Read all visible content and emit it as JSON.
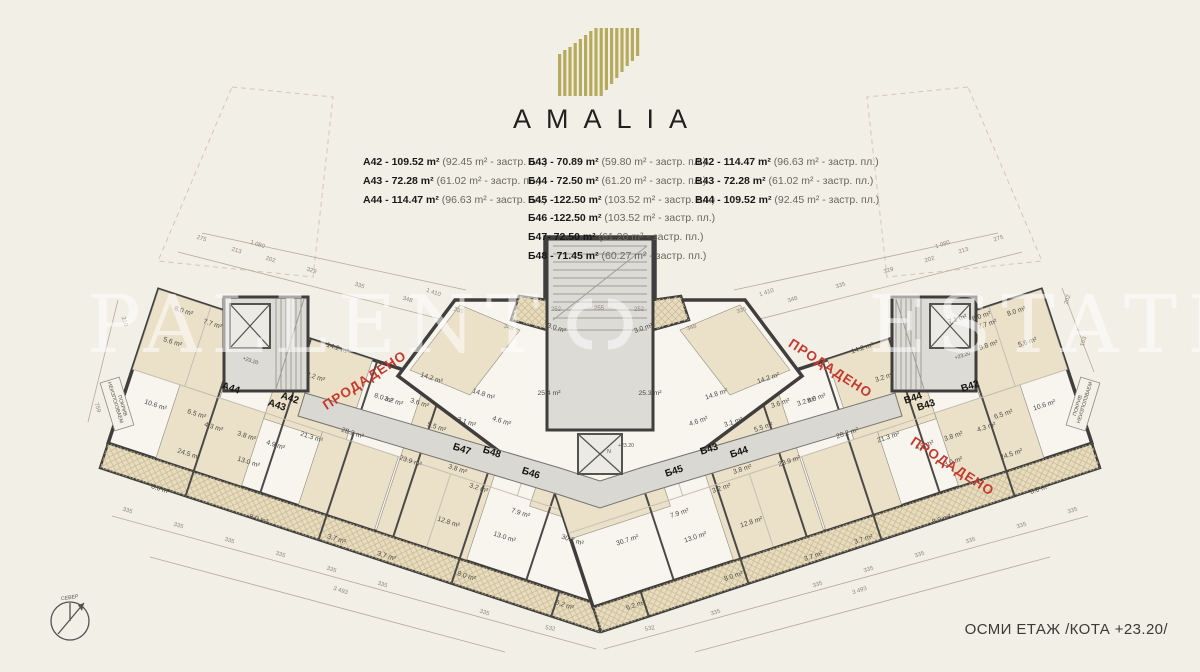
{
  "logo": {
    "title": "AMALIA"
  },
  "colors": {
    "accent_gold": "#b6aa5c",
    "sold_red": "#c43a2f",
    "wall": "#3f3e3c",
    "room_beige": "#ebe0c8"
  },
  "legend": {
    "columns": [
      {
        "items": [
          {
            "label": "A42 - 109.52 m²",
            "note": "(92.45 m² - застр. пл.)"
          },
          {
            "label": "A43 - 72.28 m²",
            "note": "(61.02 m² - застр. пл.)"
          },
          {
            "label": "A44 - 114.47 m²",
            "note": "(96.63 m² - застр. пл.)"
          }
        ]
      },
      {
        "items": [
          {
            "label": "Б43 -  70.89 m²",
            "note": "(59.80 m² - застр. пл.)"
          },
          {
            "label": "Б44 -  72.50 m²",
            "note": "(61.20 m² - застр. пл.)"
          },
          {
            "label": "Б45 -122.50 m²",
            "note": "(103.52 m² - застр. пл.)"
          },
          {
            "label": "Б46 -122.50 m²",
            "note": "(103.52 m² - застр. пл.)"
          },
          {
            "label": "Б47-  72.50 m²",
            "note": "(61.20 m² - застр. пл.)"
          },
          {
            "label": "Б48 -  71.45 m²",
            "note": "(60.27 m² - застр. пл.)"
          }
        ]
      },
      {
        "items": [
          {
            "label": "В42 -  114.47 m²",
            "note": "(96.63 m² - застр. пл.)"
          },
          {
            "label": "В43 -  72.28 m²",
            "note": "(61.02 m² - застр. пл.)"
          },
          {
            "label": "В44 - 109.52 m²",
            "note": "(92.45 m² - застр. пл.)"
          }
        ]
      }
    ]
  },
  "plan": {
    "floor_title": "ОСМИ ЕТАЖ /КОТА +23.20/",
    "watermark": {
      "left": "PALLENT",
      "right": "ESTATE"
    },
    "unit_labels": [
      {
        "t": "A44",
        "x": 230,
        "y": 391,
        "r": 18
      },
      {
        "t": "A43",
        "x": 276,
        "y": 408,
        "r": 18
      },
      {
        "t": "A42",
        "x": 289,
        "y": 401,
        "r": 18
      },
      {
        "t": "Б47",
        "x": 461,
        "y": 452,
        "r": 18
      },
      {
        "t": "Б48",
        "x": 491,
        "y": 455,
        "r": 18
      },
      {
        "t": "Б46",
        "x": 530,
        "y": 476,
        "r": 18
      },
      {
        "t": "Б45",
        "x": 675,
        "y": 474,
        "r": -18
      },
      {
        "t": "Б43",
        "x": 710,
        "y": 452,
        "r": -18
      },
      {
        "t": "Б44",
        "x": 740,
        "y": 455,
        "r": -18
      },
      {
        "t": "В44",
        "x": 914,
        "y": 401,
        "r": -18
      },
      {
        "t": "В43",
        "x": 927,
        "y": 408,
        "r": -18
      },
      {
        "t": "В42",
        "x": 971,
        "y": 389,
        "r": -18
      }
    ],
    "sold_stamps": [
      {
        "t": "ПРОДАДЕНО",
        "x": 367,
        "y": 384,
        "r": -33
      },
      {
        "t": "ПРОДАДЕНО",
        "x": 828,
        "y": 372,
        "r": 33
      },
      {
        "t": "ПРОДАДЕНО",
        "x": 950,
        "y": 470,
        "r": 33
      }
    ],
    "area_labels": [
      {
        "t": "8.0 m²",
        "x": 183,
        "y": 313,
        "r": 18
      },
      {
        "t": "7.7 m²",
        "x": 212,
        "y": 326,
        "r": 18
      },
      {
        "t": "5.6 m²",
        "x": 172,
        "y": 344,
        "r": 18
      },
      {
        "t": "14.2 m²",
        "x": 337,
        "y": 350,
        "r": 18
      },
      {
        "t": "3.2 m²",
        "x": 315,
        "y": 379,
        "r": 18
      },
      {
        "t": "3.2 m²",
        "x": 393,
        "y": 403,
        "r": 18
      },
      {
        "t": "10.6 m²",
        "x": 155,
        "y": 407,
        "r": 18
      },
      {
        "t": "6.5 m²",
        "x": 196,
        "y": 416,
        "r": 18
      },
      {
        "t": "4.3 m²",
        "x": 213,
        "y": 429,
        "r": 18
      },
      {
        "t": "3.8 m²",
        "x": 246,
        "y": 438,
        "r": 18
      },
      {
        "t": "4.9 m²",
        "x": 275,
        "y": 447,
        "r": 18
      },
      {
        "t": "21.3 m²",
        "x": 311,
        "y": 439,
        "r": 18
      },
      {
        "t": "8.0 m²",
        "x": 383,
        "y": 400,
        "r": 18
      },
      {
        "t": "28.2 m²",
        "x": 352,
        "y": 435,
        "r": 18
      },
      {
        "t": "24.5 m²",
        "x": 188,
        "y": 456,
        "r": 18
      },
      {
        "t": "13.0 m²",
        "x": 248,
        "y": 464,
        "r": 18
      },
      {
        "t": "23.9 m²",
        "x": 410,
        "y": 463,
        "r": 18
      },
      {
        "t": "8.0 m²",
        "x": 160,
        "y": 491,
        "r": 18
      },
      {
        "t": "8.0 m²",
        "x": 258,
        "y": 521,
        "r": 18
      },
      {
        "t": "3.7 m²",
        "x": 336,
        "y": 541,
        "r": 18
      },
      {
        "t": "3.7 m²",
        "x": 386,
        "y": 558,
        "r": 18
      },
      {
        "t": "12.8 m²",
        "x": 448,
        "y": 524,
        "r": 18
      },
      {
        "t": "13.0 m²",
        "x": 504,
        "y": 539,
        "r": 18
      },
      {
        "t": "7.9 m²",
        "x": 520,
        "y": 515,
        "r": 18
      },
      {
        "t": "3.2 m²",
        "x": 478,
        "y": 490,
        "r": 18
      },
      {
        "t": "3.8 m²",
        "x": 457,
        "y": 471,
        "r": 18
      },
      {
        "t": "5.5 m²",
        "x": 436,
        "y": 429,
        "r": 18
      },
      {
        "t": "3.1 m²",
        "x": 466,
        "y": 424,
        "r": 18
      },
      {
        "t": "4.6 m²",
        "x": 501,
        "y": 423,
        "r": 18
      },
      {
        "t": "14.2 m²",
        "x": 431,
        "y": 380,
        "r": 18
      },
      {
        "t": "14.8 m²",
        "x": 483,
        "y": 396,
        "r": 18
      },
      {
        "t": "3.6 m²",
        "x": 419,
        "y": 405,
        "r": 18
      },
      {
        "t": "8.0 m²",
        "x": 466,
        "y": 578,
        "r": 18
      },
      {
        "t": "6.2 m²",
        "x": 564,
        "y": 607,
        "r": 18
      },
      {
        "t": "30.7 m²",
        "x": 572,
        "y": 542,
        "r": 18
      },
      {
        "t": "3.0 m²",
        "x": 556,
        "y": 330,
        "r": 18
      },
      {
        "t": "25.4 m²",
        "x": 549,
        "y": 395,
        "r": 0
      },
      {
        "t": "25.3 m²",
        "x": 650,
        "y": 395,
        "r": 0
      },
      {
        "t": "3.0 m²",
        "x": 644,
        "y": 330,
        "r": -18
      },
      {
        "t": "30.7 m²",
        "x": 628,
        "y": 542,
        "r": -18
      },
      {
        "t": "6.2 m²",
        "x": 636,
        "y": 607,
        "r": -18
      },
      {
        "t": "8.0 m²",
        "x": 734,
        "y": 578,
        "r": -18
      },
      {
        "t": "3.6 m²",
        "x": 781,
        "y": 405,
        "r": -18
      },
      {
        "t": "14.8 m²",
        "x": 717,
        "y": 396,
        "r": -18
      },
      {
        "t": "14.2 m²",
        "x": 769,
        "y": 380,
        "r": -18
      },
      {
        "t": "4.6 m²",
        "x": 699,
        "y": 423,
        "r": -18
      },
      {
        "t": "3.1 m²",
        "x": 734,
        "y": 424,
        "r": -18
      },
      {
        "t": "5.5 m²",
        "x": 764,
        "y": 429,
        "r": -18
      },
      {
        "t": "3.8 m²",
        "x": 743,
        "y": 471,
        "r": -18
      },
      {
        "t": "3.2 m²",
        "x": 722,
        "y": 490,
        "r": -18
      },
      {
        "t": "7.9 m²",
        "x": 680,
        "y": 515,
        "r": -18
      },
      {
        "t": "13.0 m²",
        "x": 696,
        "y": 539,
        "r": -18
      },
      {
        "t": "12.8 m²",
        "x": 752,
        "y": 524,
        "r": -18
      },
      {
        "t": "3.7 m²",
        "x": 814,
        "y": 558,
        "r": -18
      },
      {
        "t": "3.7 m²",
        "x": 864,
        "y": 541,
        "r": -18
      },
      {
        "t": "8.0 m²",
        "x": 942,
        "y": 521,
        "r": -18
      },
      {
        "t": "8.0 m²",
        "x": 1040,
        "y": 491,
        "r": -18
      },
      {
        "t": "23.9 m²",
        "x": 790,
        "y": 463,
        "r": -18
      },
      {
        "t": "13.0 m²",
        "x": 952,
        "y": 464,
        "r": -18
      },
      {
        "t": "24.5 m²",
        "x": 1012,
        "y": 456,
        "r": -18
      },
      {
        "t": "21.3 m²",
        "x": 889,
        "y": 439,
        "r": -18
      },
      {
        "t": "28.2 m²",
        "x": 848,
        "y": 435,
        "r": -18
      },
      {
        "t": "4.9 m²",
        "x": 925,
        "y": 447,
        "r": -18
      },
      {
        "t": "3.8 m²",
        "x": 954,
        "y": 438,
        "r": -18
      },
      {
        "t": "4.3 m²",
        "x": 987,
        "y": 429,
        "r": -18
      },
      {
        "t": "6.5 m²",
        "x": 1004,
        "y": 416,
        "r": -18
      },
      {
        "t": "10.6 m²",
        "x": 1045,
        "y": 407,
        "r": -18
      },
      {
        "t": "8.0 m²",
        "x": 817,
        "y": 400,
        "r": -18
      },
      {
        "t": "3.2 m²",
        "x": 885,
        "y": 379,
        "r": -18
      },
      {
        "t": "3.2 m²",
        "x": 807,
        "y": 403,
        "r": -18
      },
      {
        "t": "14.2 m²",
        "x": 863,
        "y": 350,
        "r": -18
      },
      {
        "t": "5.6 m²",
        "x": 1028,
        "y": 344,
        "r": -18
      },
      {
        "t": "7.7 m²",
        "x": 988,
        "y": 326,
        "r": -18
      },
      {
        "t": "8.0 m²",
        "x": 1017,
        "y": 313,
        "r": -18
      },
      {
        "t": "7.1 m²",
        "x": 958,
        "y": 321,
        "r": -18
      },
      {
        "t": "6.0 m²",
        "x": 982,
        "y": 318,
        "r": -18
      },
      {
        "t": "9.8 m²",
        "x": 989,
        "y": 347,
        "r": -18
      }
    ],
    "dim_labels": [
      {
        "t": "275",
        "x": 201,
        "y": 240,
        "r": 18
      },
      {
        "t": "1 080",
        "x": 257,
        "y": 246,
        "r": 18
      },
      {
        "t": "213",
        "x": 236,
        "y": 252,
        "r": 18
      },
      {
        "t": "202",
        "x": 270,
        "y": 261,
        "r": 18
      },
      {
        "t": "329",
        "x": 311,
        "y": 272,
        "r": 18
      },
      {
        "t": "335",
        "x": 359,
        "y": 287,
        "r": 18
      },
      {
        "t": "1 410",
        "x": 433,
        "y": 294,
        "r": 18
      },
      {
        "t": "348",
        "x": 407,
        "y": 301,
        "r": 18
      },
      {
        "t": "335",
        "x": 458,
        "y": 312,
        "r": 18
      },
      {
        "t": "348",
        "x": 508,
        "y": 329,
        "r": 18
      },
      {
        "t": "252",
        "x": 556,
        "y": 311,
        "r": 0
      },
      {
        "t": "255",
        "x": 599,
        "y": 310,
        "r": 0
      },
      {
        "t": "252",
        "x": 639,
        "y": 311,
        "r": 0
      },
      {
        "t": "348",
        "x": 692,
        "y": 329,
        "r": -18
      },
      {
        "t": "335",
        "x": 742,
        "y": 312,
        "r": -18
      },
      {
        "t": "348",
        "x": 793,
        "y": 301,
        "r": -18
      },
      {
        "t": "1 410",
        "x": 767,
        "y": 294,
        "r": -18
      },
      {
        "t": "335",
        "x": 841,
        "y": 287,
        "r": -18
      },
      {
        "t": "329",
        "x": 889,
        "y": 272,
        "r": -18
      },
      {
        "t": "202",
        "x": 930,
        "y": 261,
        "r": -18
      },
      {
        "t": "213",
        "x": 964,
        "y": 252,
        "r": -18
      },
      {
        "t": "1 080",
        "x": 943,
        "y": 246,
        "r": -18
      },
      {
        "t": "275",
        "x": 999,
        "y": 240,
        "r": -18
      },
      {
        "t": "335",
        "x": 127,
        "y": 512,
        "r": 18
      },
      {
        "t": "335",
        "x": 178,
        "y": 527,
        "r": 18
      },
      {
        "t": "335",
        "x": 229,
        "y": 542,
        "r": 18
      },
      {
        "t": "335",
        "x": 280,
        "y": 556,
        "r": 18
      },
      {
        "t": "335",
        "x": 331,
        "y": 571,
        "r": 18
      },
      {
        "t": "3 493",
        "x": 340,
        "y": 592,
        "r": 18
      },
      {
        "t": "335",
        "x": 382,
        "y": 586,
        "r": 18
      },
      {
        "t": "335",
        "x": 484,
        "y": 614,
        "r": 18
      },
      {
        "t": "532",
        "x": 550,
        "y": 630,
        "r": 10
      },
      {
        "t": "532",
        "x": 650,
        "y": 630,
        "r": -10
      },
      {
        "t": "335",
        "x": 716,
        "y": 614,
        "r": -18
      },
      {
        "t": "335",
        "x": 818,
        "y": 586,
        "r": -18
      },
      {
        "t": "3 493",
        "x": 860,
        "y": 592,
        "r": -18
      },
      {
        "t": "335",
        "x": 869,
        "y": 571,
        "r": -18
      },
      {
        "t": "335",
        "x": 920,
        "y": 556,
        "r": -18
      },
      {
        "t": "335",
        "x": 971,
        "y": 542,
        "r": -18
      },
      {
        "t": "335",
        "x": 1022,
        "y": 527,
        "r": -18
      },
      {
        "t": "335",
        "x": 1073,
        "y": 512,
        "r": -18
      },
      {
        "t": "210",
        "x": 123,
        "y": 322,
        "r": 72
      },
      {
        "t": "759",
        "x": 96,
        "y": 408,
        "r": 72
      },
      {
        "t": "202",
        "x": 1069,
        "y": 300,
        "r": -72
      },
      {
        "t": "103",
        "x": 1085,
        "y": 342,
        "r": -72
      }
    ],
    "misc_labels": [
      {
        "t": "+23.20",
        "x": 250,
        "y": 362,
        "r": 18
      },
      {
        "t": "+23.20",
        "x": 626,
        "y": 447,
        "r": 0
      },
      {
        "t": "+23.20",
        "x": 963,
        "y": 357,
        "r": -18
      },
      {
        "t": "N",
        "x": 609,
        "y": 453,
        "r": 0
      },
      {
        "t": "СЕВЕР",
        "x": 70,
        "y": 599,
        "r": -8
      },
      {
        "t": "НЕИЗПОЛЗВАЕМ",
        "x": 114,
        "y": 403,
        "r": 73
      },
      {
        "t": "ПОКРИВ",
        "x": 121,
        "y": 406,
        "r": 73
      },
      {
        "t": "НЕИЗПОЛЗВАЕМ",
        "x": 1086,
        "y": 403,
        "r": -73
      },
      {
        "t": "ПОКРИВ",
        "x": 1079,
        "y": 406,
        "r": -73
      }
    ]
  }
}
